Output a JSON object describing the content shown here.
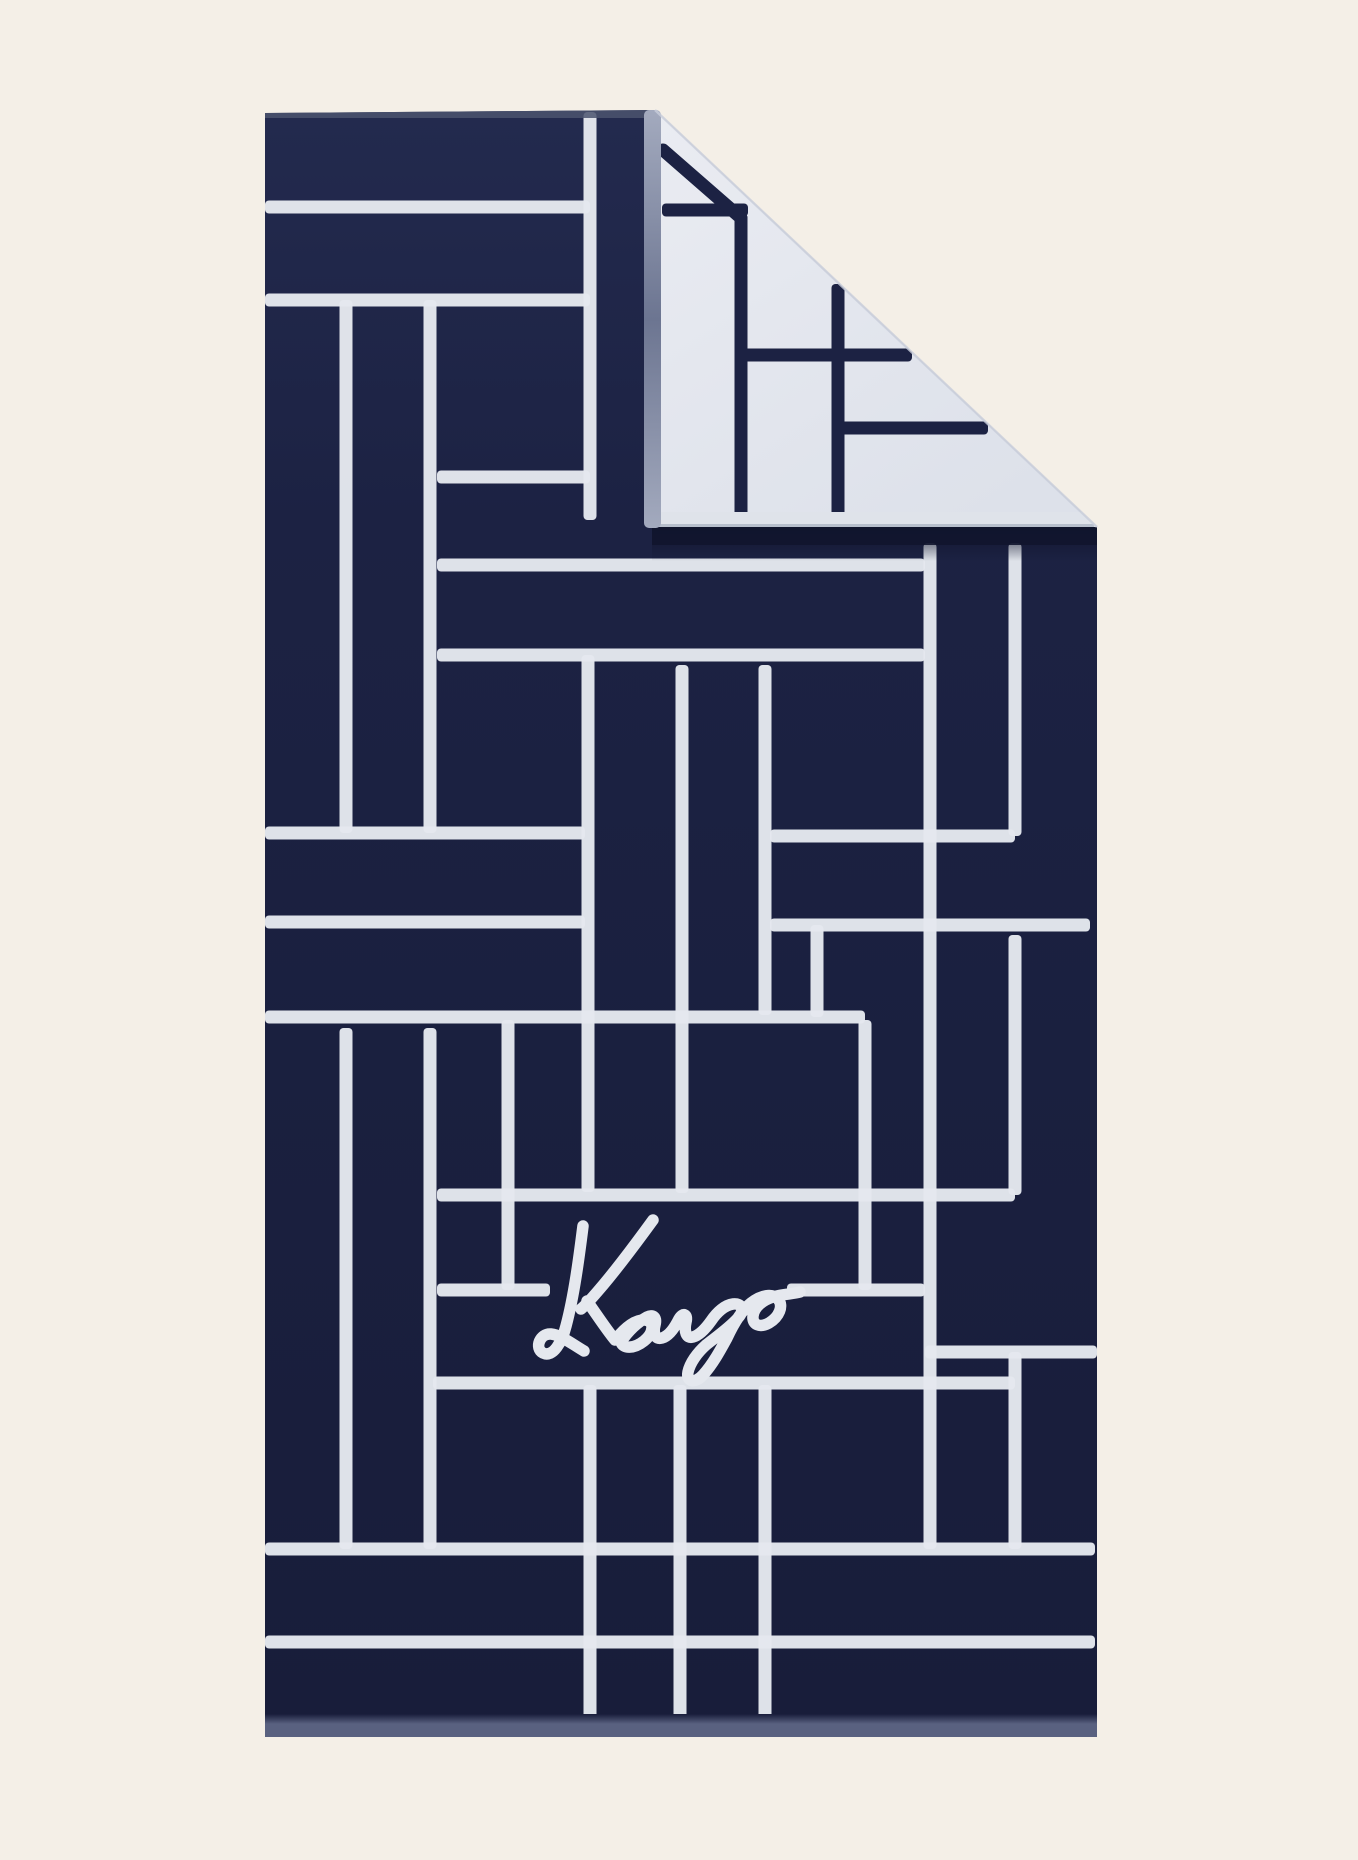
{
  "meta": {
    "description": "Product photo of a navy KENZO beach towel with white geometric line pattern, top-right corner folded over showing the white reverse side",
    "alt_text": "Navy blue towel with white graphic lines and Kenzo signature, corner folded showing white reverse"
  },
  "canvas": {
    "width": 1358,
    "height": 1860,
    "background": "#f4efe7"
  },
  "colors": {
    "navy": "#1c2243",
    "navy_light": "#232a4e",
    "navy_dark": "#181d3a",
    "line_white": "#e5e8ee",
    "flap_white": "#eaecf2",
    "flap_white_shade": "#dde1ea",
    "flap_line_navy": "#1c2243",
    "spine_grey_light": "#a3aabe",
    "spine_grey_dark": "#6c7591",
    "top_hem": "#4b536f",
    "bottom_hem": "#596180",
    "fold_shadow": "#11152e",
    "crease_edge": "#c9cedb",
    "flap_hem": "#dfe3ea",
    "flap_hem_line": "#b3bac9"
  },
  "towel": {
    "front": {
      "outline_polygon": [
        [
          265,
          113
        ],
        [
          655,
          110
        ],
        [
          1097,
          527
        ],
        [
          1097,
          1737
        ],
        [
          265,
          1737
        ]
      ],
      "line_width": 13,
      "h_lines": [
        [
          207,
          265,
          590
        ],
        [
          300,
          265,
          590
        ],
        [
          477,
          437,
          590
        ],
        [
          565,
          437,
          925
        ],
        [
          655,
          437,
          925
        ],
        [
          833,
          265,
          585
        ],
        [
          836,
          770,
          1015
        ],
        [
          922,
          265,
          585
        ],
        [
          925,
          770,
          1090
        ],
        [
          1017,
          265,
          865
        ],
        [
          1195,
          437,
          1015
        ],
        [
          1290,
          437,
          550
        ],
        [
          1290,
          787,
          925
        ],
        [
          1352,
          925,
          1097
        ],
        [
          1383,
          433,
          1015
        ],
        [
          1549,
          265,
          1095
        ],
        [
          1642,
          265,
          1095
        ]
      ],
      "v_lines": [
        [
          590,
          112,
          520
        ],
        [
          346,
          300,
          833
        ],
        [
          430,
          300,
          833
        ],
        [
          588,
          655,
          1192
        ],
        [
          682,
          665,
          1193
        ],
        [
          765,
          665,
          1015
        ],
        [
          817,
          925,
          1017
        ],
        [
          930,
          543,
          1549
        ],
        [
          1015,
          543,
          836
        ],
        [
          1015,
          935,
          1195
        ],
        [
          1015,
          1352,
          1549
        ],
        [
          865,
          1020,
          1290
        ],
        [
          508,
          1020,
          1290
        ],
        [
          346,
          1028,
          1549
        ],
        [
          430,
          1028,
          1549
        ],
        [
          680,
          1385,
          1733
        ],
        [
          765,
          1385,
          1733
        ],
        [
          590,
          1385,
          1733
        ]
      ],
      "top_hem": {
        "x1": 265,
        "x2": 652,
        "y": 110,
        "h": 8
      },
      "bottom_hem": {
        "x1": 265,
        "x2": 1097,
        "y": 1724,
        "h": 13
      }
    },
    "flap": {
      "triangle": [
        [
          655,
          110
        ],
        [
          1097,
          527
        ],
        [
          655,
          527
        ]
      ],
      "line_width": 13,
      "h_lines": [
        [
          210,
          662,
          748
        ],
        [
          355,
          741,
          912
        ],
        [
          428,
          838,
          988
        ]
      ],
      "v_lines": [
        [
          741,
          214,
          522
        ],
        [
          838,
          284,
          522
        ]
      ],
      "diagonal_line": [
        663,
        150,
        741,
        218
      ],
      "spine": {
        "x": 644,
        "w": 17,
        "y1": 110,
        "y2": 528
      },
      "bottom_hem": {
        "x1": 650,
        "x2": 1094,
        "y": 512,
        "h": 16
      },
      "shadow": {
        "x1": 652,
        "x2": 1097,
        "y": 527,
        "h": 18,
        "soft_h": 34
      }
    },
    "logo": {
      "text": "Kenzo",
      "stroke_width": 11.5,
      "paths": [
        "M 583 1226 C 579 1258 574 1296 566 1326 C 562 1342 553 1358 543 1353 C 534 1348 540 1333 551 1334 C 561 1335 572 1344 584 1351",
        "M 653 1220 C 637 1242 618 1268 598 1291 C 592 1298 586 1305 581 1309",
        "M 587 1301 C 597 1315 606 1329 615 1340 C 623 1330 634 1319 645 1320 C 655 1321 654 1333 644 1341 C 634 1349 623 1349 621 1342 C 628 1331 638 1322 647 1317 C 653 1314 657 1317 655 1325 C 653 1333 655 1340 662 1338 C 669 1336 675 1327 679 1319 C 683 1312 688 1314 686 1322 C 684 1331 686 1339 693 1337 C 700 1335 706 1328 711 1321 C 717 1312 725 1305 733 1304 C 742 1303 745 1310 738 1318 C 729 1328 716 1337 706 1345 C 697 1353 690 1363 688 1372 C 686 1382 695 1384 703 1375 C 713 1364 721 1349 727 1338 C 733 1325 741 1311 751 1303 C 761 1295 772 1293 778 1299 C 784 1306 779 1317 769 1323 C 760 1328 752 1325 753 1316 C 754 1307 763 1300 773 1297 C 783 1294 793 1294 800 1292"
      ]
    }
  }
}
